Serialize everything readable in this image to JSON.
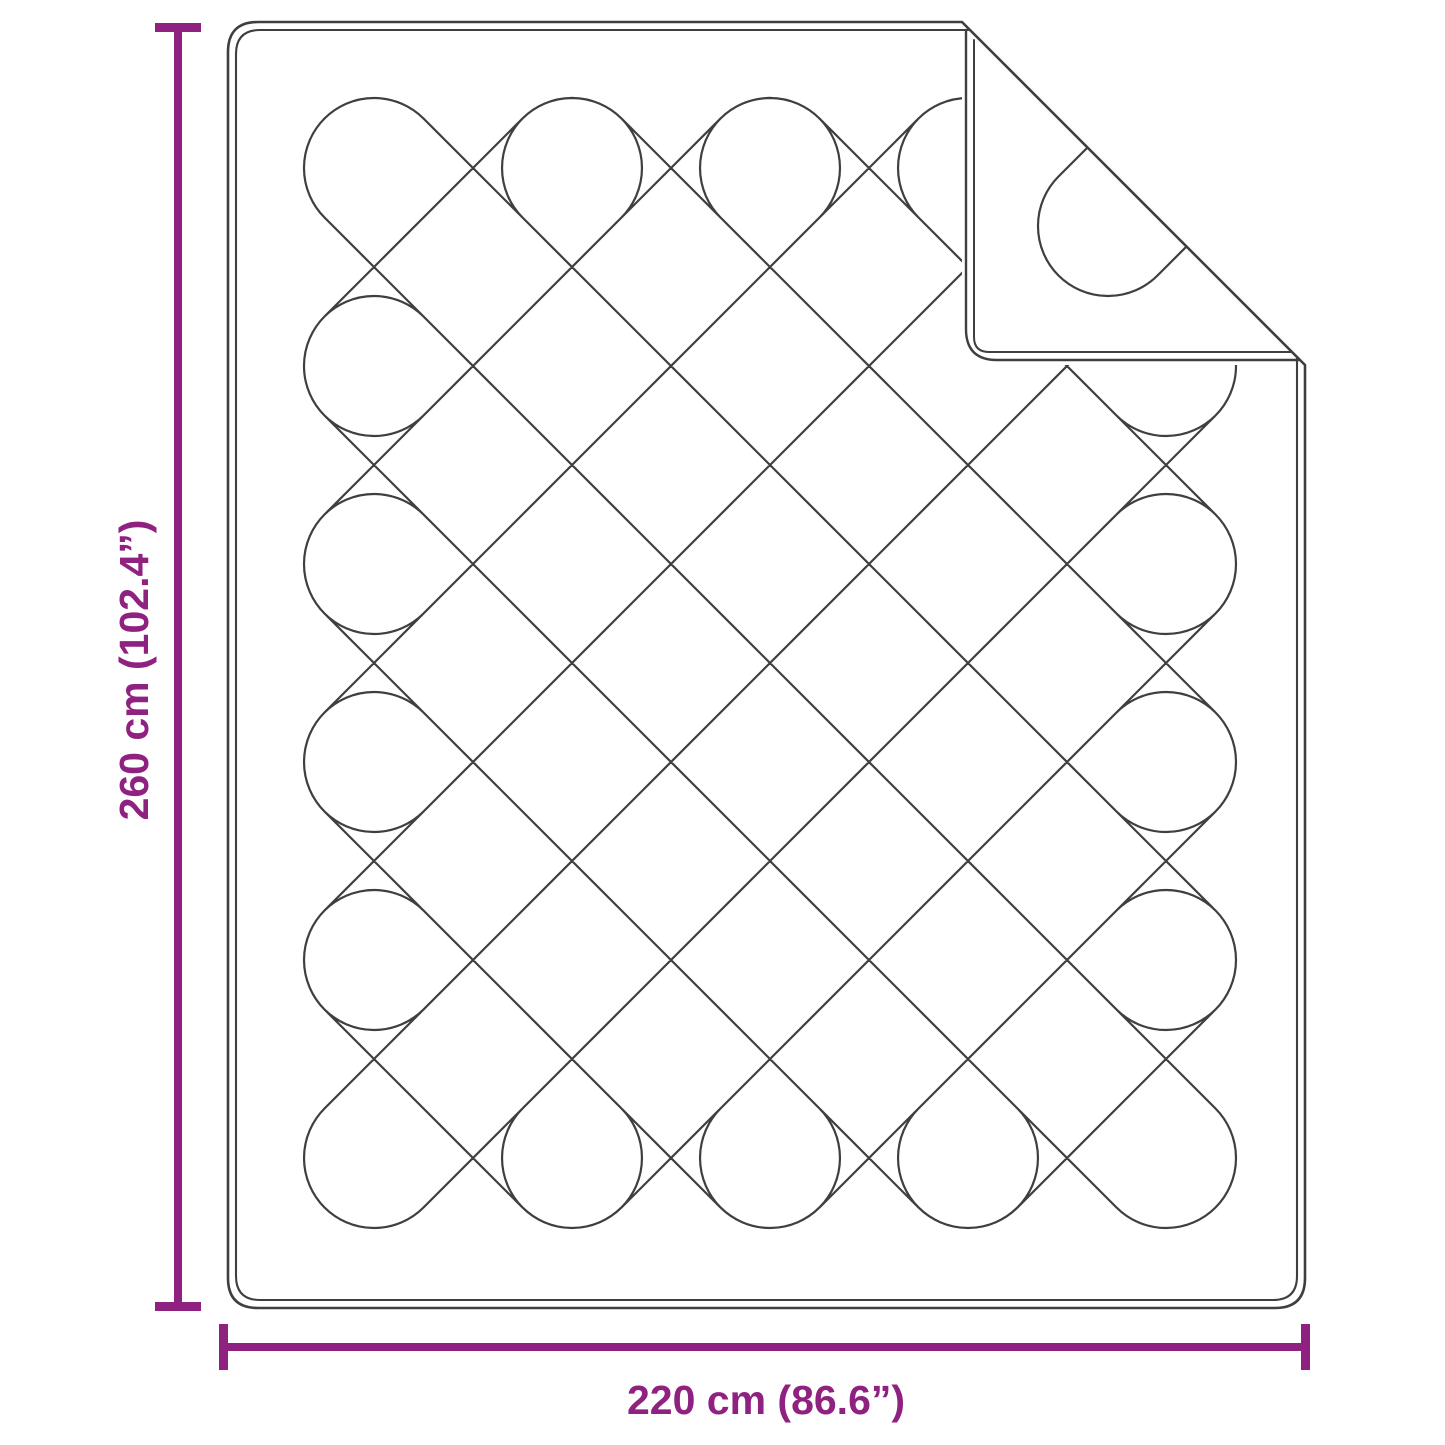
{
  "page": {
    "background": "#ffffff"
  },
  "figure": {
    "type": "product-dimension-diagram",
    "subject": "quilted blanket with folded top-right corner",
    "line_color": "#3f3f3f",
    "accent_color": "#8f2180",
    "height_label": "260 cm (102.4”)",
    "width_label": "220 cm (86.6”)",
    "quilt": {
      "grid_period": 198,
      "cap_radius": 70,
      "a_start": -1180,
      "a_end": 1196,
      "s_start": 146,
      "s_end": 2522,
      "cap_center_bounds": [
        372,
        164,
        1170,
        1168
      ],
      "fold_line_offset": 940
    }
  }
}
